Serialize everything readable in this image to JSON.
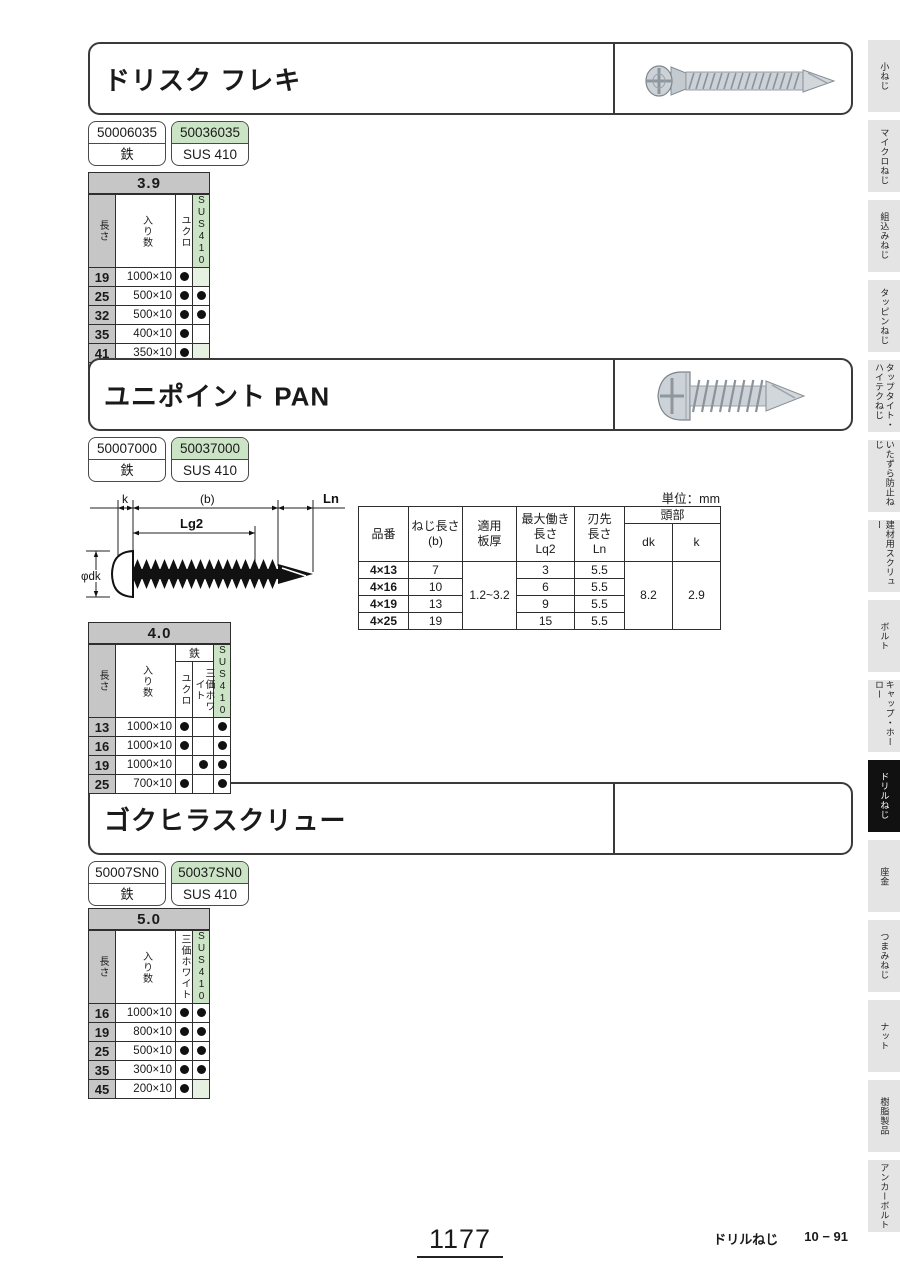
{
  "sections": [
    {
      "title": "ドリスク フレキ",
      "parts": [
        {
          "code": "50006035",
          "material": "鉄",
          "highlight": false
        },
        {
          "code": "50036035",
          "material": "SUS 410",
          "highlight": true
        }
      ],
      "table": {
        "size": "3.9",
        "length_header": "長さ",
        "qty_header": "入り数",
        "group": null,
        "finishes": [
          "ユクロ",
          "SUS410"
        ],
        "hdr_h": 56,
        "row_h": 14,
        "rows": [
          {
            "len": "19",
            "qty": "1000×10",
            "dots": [
              1,
              2
            ]
          },
          {
            "len": "25",
            "qty": "500×10",
            "dots": [
              1,
              1
            ]
          },
          {
            "len": "32",
            "qty": "500×10",
            "dots": [
              1,
              1
            ]
          },
          {
            "len": "35",
            "qty": "400×10",
            "dots": [
              1,
              0
            ]
          },
          {
            "len": "41",
            "qty": "350×10",
            "dots": [
              1,
              2
            ]
          },
          {
            "len": "51",
            "qty": "300×10",
            "dots": [
              1,
              0
            ]
          }
        ]
      }
    },
    {
      "title": "ユニポイント PAN",
      "parts": [
        {
          "code": "50007000",
          "material": "鉄",
          "highlight": false
        },
        {
          "code": "50037000",
          "material": "SUS 410",
          "highlight": true
        }
      ],
      "table": {
        "size": "4.0",
        "length_header": "長さ",
        "qty_header": "入り数",
        "group": {
          "label": "鉄",
          "span": 2
        },
        "finishes": [
          "ユクロ",
          "三価ホワイト",
          "SUS410"
        ],
        "hdr_h": 54,
        "row_h": 15,
        "rows": [
          {
            "len": "13",
            "qty": "1000×10",
            "dots": [
              1,
              0,
              1
            ]
          },
          {
            "len": "16",
            "qty": "1000×10",
            "dots": [
              1,
              0,
              1
            ]
          },
          {
            "len": "19",
            "qty": "1000×10",
            "dots": [
              0,
              1,
              1
            ]
          },
          {
            "len": "25",
            "qty": "700×10",
            "dots": [
              1,
              0,
              1
            ]
          }
        ]
      }
    },
    {
      "title": "ゴクヒラスクリュー",
      "parts": [
        {
          "code": "50007SN0",
          "material": "鉄",
          "highlight": false
        },
        {
          "code": "50037SN0",
          "material": "SUS 410",
          "highlight": true
        }
      ],
      "table": {
        "size": "5.0",
        "length_header": "長さ",
        "qty_header": "入り数",
        "group": null,
        "finishes": [
          "三価ホワイト",
          "SUS410"
        ],
        "hdr_h": 66,
        "row_h": 14,
        "rows": [
          {
            "len": "16",
            "qty": "1000×10",
            "dots": [
              1,
              1
            ]
          },
          {
            "len": "19",
            "qty": "800×10",
            "dots": [
              1,
              1
            ]
          },
          {
            "len": "25",
            "qty": "500×10",
            "dots": [
              1,
              1
            ]
          },
          {
            "len": "35",
            "qty": "300×10",
            "dots": [
              1,
              1
            ]
          },
          {
            "len": "45",
            "qty": "200×10",
            "dots": [
              1,
              2
            ]
          }
        ]
      }
    }
  ],
  "diagram": {
    "labels": {
      "k": "k",
      "b": "(b)",
      "ln": "Ln",
      "lg2": "Lg2",
      "dk": "φdk"
    }
  },
  "spec_table": {
    "unit": "単位：mm",
    "col_headers": {
      "part": "品番",
      "screw_len": "ねじ長さ\n(b)",
      "plate": "適用\n板厚",
      "work_len": "最大働き\n長さ\nLq2",
      "tip_len": "刃先\n長さ\nLn",
      "head": "頭部",
      "dk": "dk",
      "k": "k"
    },
    "rows": [
      {
        "part": "4×13",
        "b": "7",
        "lq2": "3",
        "ln": "5.5"
      },
      {
        "part": "4×16",
        "b": "10",
        "lq2": "6",
        "ln": "5.5"
      },
      {
        "part": "4×19",
        "b": "13",
        "lq2": "9",
        "ln": "5.5"
      },
      {
        "part": "4×25",
        "b": "19",
        "lq2": "15",
        "ln": "5.5"
      }
    ],
    "shared": {
      "plate": "1.2~3.2",
      "dk": "8.2",
      "k": "2.9"
    }
  },
  "sidebar": {
    "items": [
      {
        "label": "小ねじ",
        "active": false
      },
      {
        "label": "マイクロねじ",
        "active": false
      },
      {
        "label": "組込みねじ",
        "active": false
      },
      {
        "label": "タッピンねじ",
        "active": false
      },
      {
        "label": "タップタイト・\nハイテクねじ",
        "active": false
      },
      {
        "label": "いたずら防止ねじ",
        "active": false
      },
      {
        "label": "建材用スクリュー",
        "active": false
      },
      {
        "label": "ボルト",
        "active": false
      },
      {
        "label": "キャップ・ホーロー",
        "active": false
      },
      {
        "label": "ドリルねじ",
        "active": true
      },
      {
        "label": "座金",
        "active": false
      },
      {
        "label": "つまみねじ",
        "active": false
      },
      {
        "label": "ナット",
        "active": false
      },
      {
        "label": "樹脂製品",
        "active": false
      },
      {
        "label": "アンカーボルト",
        "active": false
      }
    ]
  },
  "footer": {
    "page": "1177",
    "category": "ドリルねじ",
    "code": "10 − 91"
  },
  "colors": {
    "green": "#cce4c6",
    "header_gray": "#c6c6c6",
    "active_tab": "#111111"
  }
}
